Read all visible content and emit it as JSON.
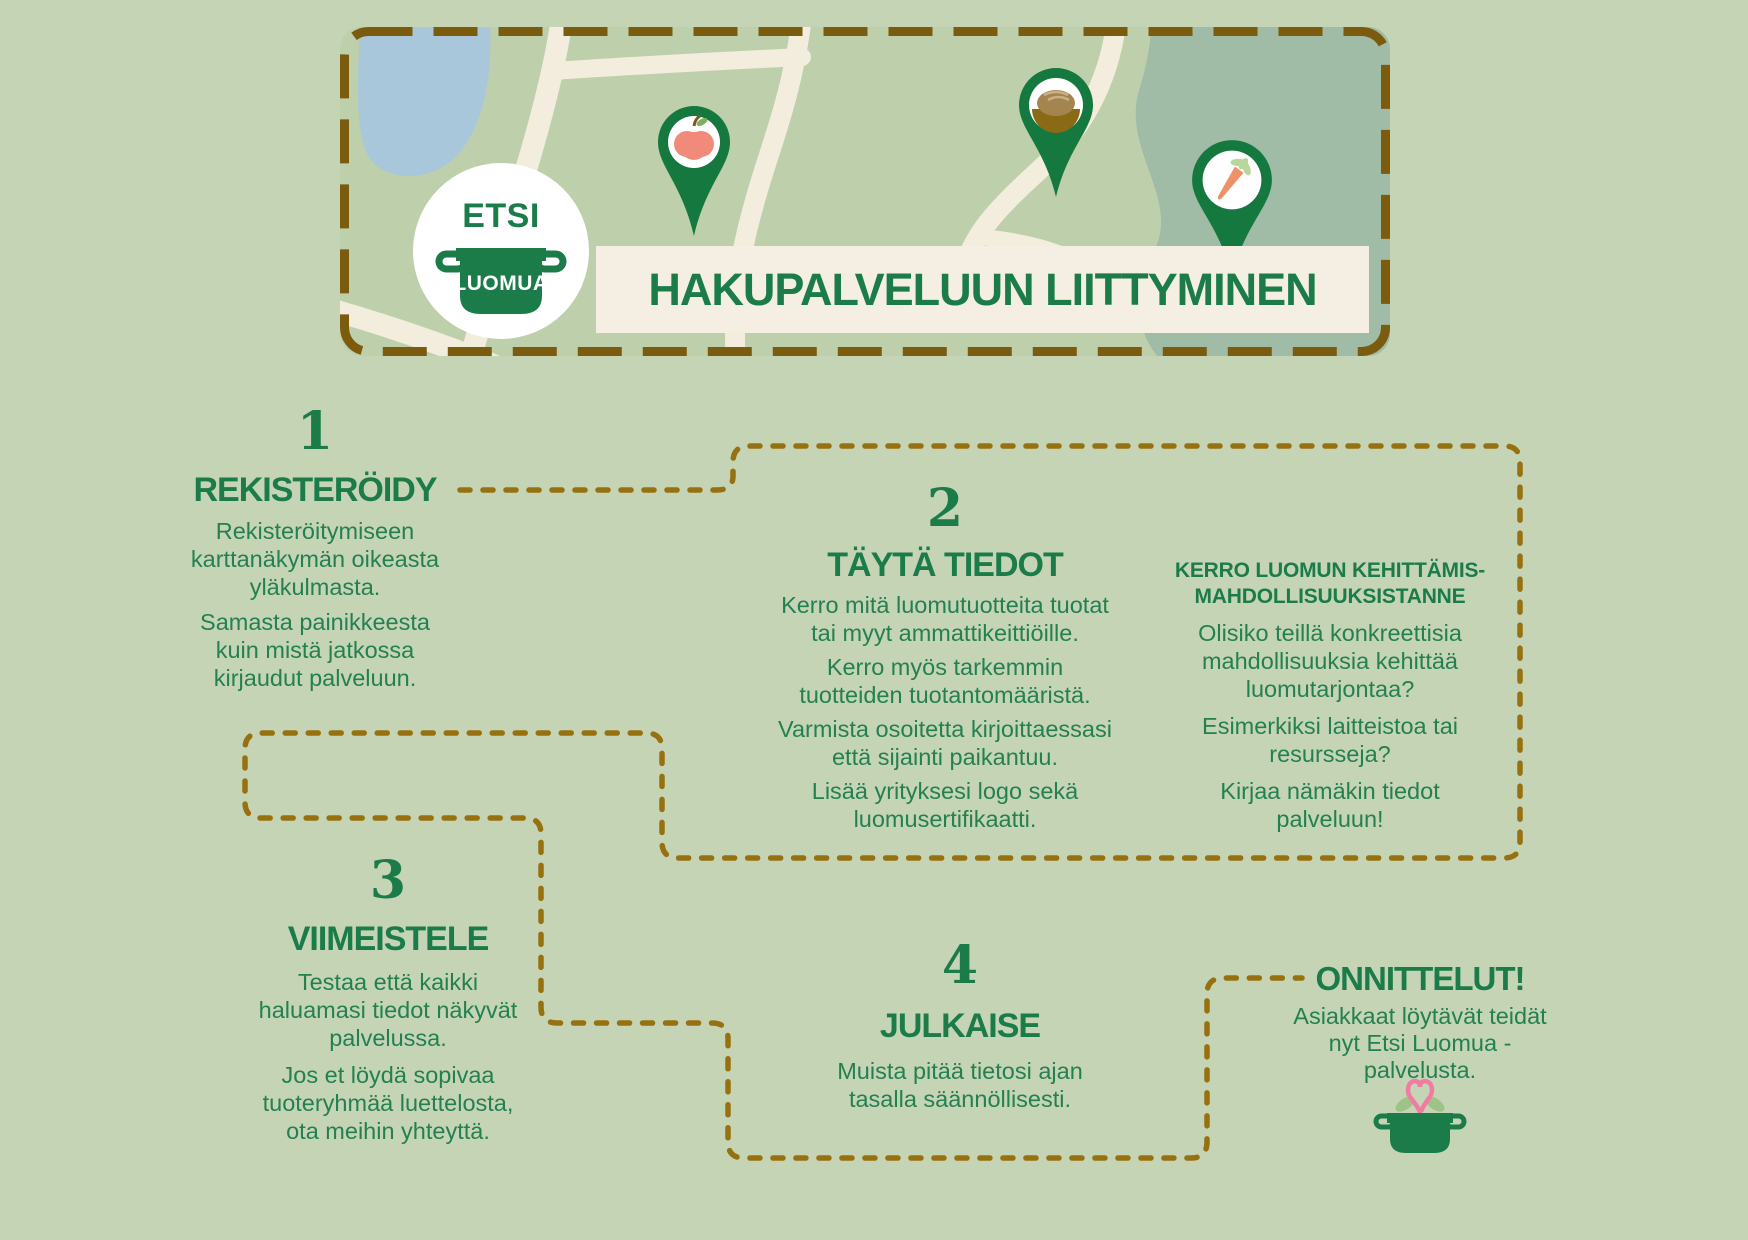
{
  "colors": {
    "background": "#c6d4b6",
    "heading_green": "#1b7c49",
    "body_green": "#23814f",
    "dash_brown": "#97700f",
    "border_brown": "#7b5b0d",
    "banner_cream": "#f4efe2",
    "map_green": "#becfab",
    "map_dark_green": "#a0bba6",
    "lake_blue": "#a9c7da",
    "road_cream": "#f3eddd",
    "pin_green": "#15793f",
    "apple_red": "#f28a7b",
    "bread_brown": "#a5854f",
    "carrot_orange": "#ef9166",
    "heart_pink": "#f27ba2",
    "leaf_green": "#9cc487"
  },
  "header": {
    "logo": {
      "top": "ETSI",
      "bottom": "LUOMUA"
    },
    "title": "HAKUPALVELUUN LIITTYMINEN",
    "map_pin_icons": [
      "apple-pin-icon",
      "bread-pin-icon",
      "carrot-pin-icon"
    ]
  },
  "steps": [
    {
      "number": "1",
      "title": "REKISTERÖIDY",
      "paragraphs": [
        "Rekisteröitymiseen\nkarttanäkymän oikeasta\nyläkulmasta.",
        "Samasta painikkeesta\nkuin mistä jatkossa\nkirjaudut palveluun."
      ]
    },
    {
      "number": "2",
      "title": "TÄYTÄ TIEDOT",
      "paragraphs": [
        "Kerro mitä luomutuotteita tuotat\ntai myyt ammattikeittiöille.",
        "Kerro myös tarkemmin\ntuotteiden tuotantomääristä.",
        "Varmista osoitetta kirjoittaessasi\nettä sijainti paikantuu.",
        "Lisää yrityksesi logo sekä\nluomusertifikaatti."
      ]
    },
    {
      "number": "3",
      "title": "VIIMEISTELE",
      "paragraphs": [
        "Testaa että kaikki\nhaluamasi tiedot näkyvät\npalvelussa.",
        "Jos et löydä sopivaa\ntuoteryhmää luettelosta,\nota meihin yhteyttä."
      ]
    },
    {
      "number": "4",
      "title": "JULKAISE",
      "paragraphs": [
        "Muista pitää tietosi ajan\ntasalla säännöllisesti."
      ]
    }
  ],
  "side_note": {
    "title": "KERRO LUOMUN KEHITTÄMIS-\nMAHDOLLISUUKSISTANNE",
    "paragraphs": [
      "Olisiko teillä konkreettisia\nmahdollisuuksia kehittää\nluomutarjontaa?",
      "Esimerkiksi laitteistoa tai\nresursseja?",
      "Kirjaa nämäkin tiedot\npalveluun!"
    ]
  },
  "outro": {
    "title": "ONNITTELUT!",
    "paragraph": "Asiakkaat löytävät teidät\nnyt Etsi Luomua -\npalvelusta."
  }
}
